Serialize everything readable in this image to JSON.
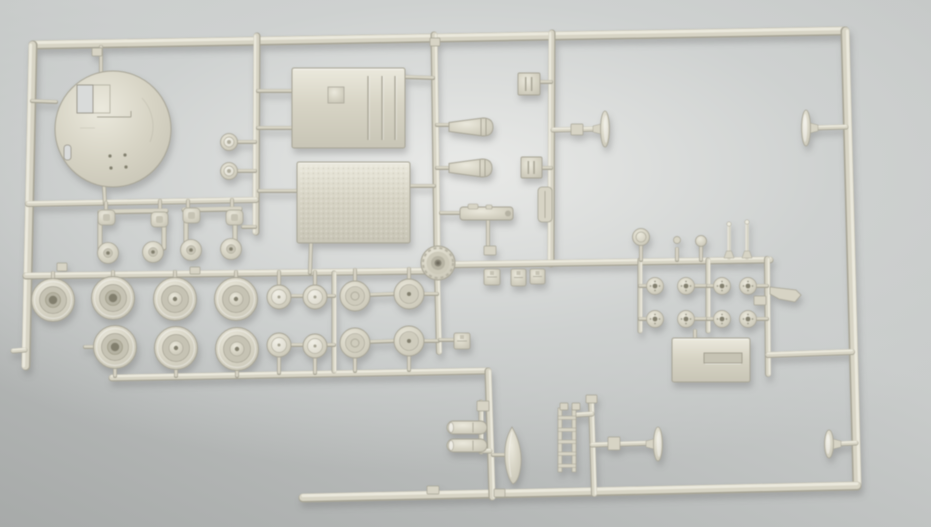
{
  "scene": {
    "description": "Photograph of a cream-colored injection-molded plastic model kit sprue (parts tree) with tank parts - wheels, hull panels, circular base plate, hatches and small fittings - lying on a gray surface",
    "palette": {
      "plastic_light": "#ebe9dd",
      "plastic_base": "#d7d4c5",
      "plastic_mid": "#c8c5b6",
      "plastic_dark": "#a7a495",
      "recess": "#c6c3b4",
      "recess_deep": "#b5b2a2",
      "hole_dark": "#827f6e",
      "bg_hole": "#d9dbda",
      "shadow": "#696c6b",
      "bg_light": "#e9eae8",
      "bg_mid": "#ced1d0",
      "bg_dark": "#a7aaa9"
    }
  },
  "sprue": {
    "frame_runners": [
      {
        "name": "runner-frame-top",
        "x1": 33,
        "y1": 45,
        "x2": 845,
        "y2": 31,
        "w": 9
      },
      {
        "name": "runner-frame-right",
        "x1": 845,
        "y1": 31,
        "x2": 857,
        "y2": 486,
        "w": 9
      },
      {
        "name": "runner-frame-bottom",
        "x1": 857,
        "y1": 486,
        "x2": 303,
        "y2": 498,
        "w": 9
      },
      {
        "name": "runner-frame-left",
        "x1": 33,
        "y1": 45,
        "x2": 26,
        "y2": 366,
        "w": 9
      }
    ],
    "inner_runners": [
      {
        "name": "runner-v1",
        "x1": 257,
        "y1": 36,
        "x2": 256,
        "y2": 232,
        "w": 7
      },
      {
        "name": "runner-v2",
        "x1": 434,
        "y1": 35,
        "x2": 437,
        "y2": 250,
        "w": 7
      },
      {
        "name": "runner-v3",
        "x1": 552,
        "y1": 33,
        "x2": 551,
        "y2": 264,
        "w": 7
      },
      {
        "name": "runner-frames-branch",
        "x1": 28,
        "y1": 204,
        "x2": 256,
        "y2": 200,
        "w": 6
      },
      {
        "name": "runner-wheels-top",
        "x1": 26,
        "y1": 276,
        "x2": 437,
        "y2": 271,
        "w": 7
      },
      {
        "name": "runner-wheel-column",
        "x1": 437,
        "y1": 271,
        "x2": 439,
        "y2": 352,
        "w": 6
      },
      {
        "name": "runner-wheels-bottom",
        "x1": 112,
        "y1": 378,
        "x2": 488,
        "y2": 371,
        "w": 7
      },
      {
        "name": "runner-center-lower",
        "x1": 488,
        "y1": 371,
        "x2": 492,
        "y2": 497,
        "w": 7
      },
      {
        "name": "runner-mid-horizontal",
        "x1": 437,
        "y1": 265,
        "x2": 770,
        "y2": 260,
        "w": 7
      },
      {
        "name": "runner-sub-right-1",
        "x1": 640,
        "y1": 260,
        "x2": 640,
        "y2": 331,
        "w": 5
      },
      {
        "name": "runner-sub-right-2",
        "x1": 708,
        "y1": 260,
        "x2": 708,
        "y2": 331,
        "w": 5
      },
      {
        "name": "runner-sub-right-3",
        "x1": 767,
        "y1": 259,
        "x2": 768,
        "y2": 374,
        "w": 6
      },
      {
        "name": "runner-right-link",
        "x1": 768,
        "y1": 355,
        "x2": 852,
        "y2": 352,
        "w": 6
      },
      {
        "name": "runner-lower-right",
        "x1": 591,
        "y1": 399,
        "x2": 594,
        "y2": 494,
        "w": 6
      },
      {
        "name": "runner-ladder-branch",
        "x1": 576,
        "y1": 415,
        "x2": 592,
        "y2": 414,
        "w": 5
      },
      {
        "name": "runner-idler-branch",
        "x1": 592,
        "y1": 445,
        "x2": 654,
        "y2": 443,
        "w": 5
      },
      {
        "name": "runner-mini-wheels",
        "x1": 334,
        "y1": 273,
        "x2": 334,
        "y2": 371,
        "w": 5
      },
      {
        "name": "runner-mini-cylinders",
        "x1": 481,
        "y1": 402,
        "x2": 481,
        "y2": 452,
        "w": 5
      },
      {
        "name": "runner-cyl-elbow",
        "x1": 481,
        "y1": 451,
        "x2": 490,
        "y2": 451,
        "w": 5
      },
      {
        "name": "runner-t1-branch",
        "x1": 553,
        "y1": 130,
        "x2": 601,
        "y2": 129,
        "w": 5
      },
      {
        "name": "stem-idler-right-top",
        "x1": 812,
        "y1": 128,
        "x2": 846,
        "y2": 127,
        "w": 5
      },
      {
        "name": "stem-idler-right-bottom",
        "x1": 836,
        "y1": 444,
        "x2": 856,
        "y2": 443,
        "w": 5
      },
      {
        "name": "stem-left-foot",
        "x1": 25,
        "y1": 350,
        "x2": 13,
        "y2": 351,
        "w": 5
      }
    ],
    "stems": [
      [
        101,
        47,
        101,
        73
      ],
      [
        32,
        101,
        56,
        102
      ],
      [
        104,
        186,
        105,
        204
      ],
      [
        258,
        91,
        293,
        91
      ],
      [
        258,
        128,
        293,
        128
      ],
      [
        404,
        77,
        433,
        78
      ],
      [
        259,
        191,
        298,
        191
      ],
      [
        410,
        186,
        434,
        186
      ],
      [
        311,
        243,
        310,
        273
      ],
      [
        238,
        142,
        255,
        142
      ],
      [
        238,
        171,
        255,
        171
      ],
      [
        106,
        203,
        106,
        212
      ],
      [
        160,
        201,
        160,
        212
      ],
      [
        188,
        201,
        188,
        210
      ],
      [
        232,
        200,
        232,
        209
      ],
      [
        243,
        227,
        255,
        227
      ],
      [
        53,
        273,
        53,
        282
      ],
      [
        113,
        272,
        113,
        281
      ],
      [
        175,
        272,
        175,
        281
      ],
      [
        236,
        272,
        236,
        281
      ],
      [
        279,
        272,
        279,
        286
      ],
      [
        315,
        272,
        315,
        286
      ],
      [
        355,
        270,
        355,
        282
      ],
      [
        409,
        269,
        409,
        280
      ],
      [
        115,
        368,
        115,
        376
      ],
      [
        176,
        369,
        176,
        376
      ],
      [
        237,
        370,
        237,
        376
      ],
      [
        279,
        356,
        279,
        373
      ],
      [
        315,
        357,
        315,
        373
      ],
      [
        355,
        357,
        355,
        371
      ],
      [
        409,
        355,
        409,
        370
      ],
      [
        85,
        347,
        94,
        347
      ],
      [
        368,
        295,
        395,
        294
      ],
      [
        368,
        342,
        395,
        341
      ],
      [
        292,
        296,
        304,
        296
      ],
      [
        292,
        345,
        304,
        345
      ],
      [
        326,
        296,
        334,
        296
      ],
      [
        326,
        345,
        334,
        345
      ],
      [
        424,
        294,
        437,
        294
      ],
      [
        424,
        341,
        438,
        341
      ],
      [
        440,
        340,
        454,
        340
      ],
      [
        640,
        286,
        648,
        286
      ],
      [
        694,
        286,
        708,
        286
      ],
      [
        708,
        286,
        714,
        286
      ],
      [
        755,
        286,
        767,
        286
      ],
      [
        640,
        319,
        648,
        319
      ],
      [
        694,
        319,
        708,
        319
      ],
      [
        708,
        319,
        714,
        319
      ],
      [
        755,
        319,
        767,
        319
      ],
      [
        437,
        125,
        450,
        125
      ],
      [
        437,
        168,
        450,
        168
      ],
      [
        540,
        82,
        551,
        82
      ],
      [
        542,
        168,
        551,
        168
      ],
      [
        441,
        213,
        462,
        213
      ],
      [
        488,
        221,
        488,
        252
      ],
      [
        695,
        331,
        695,
        339
      ],
      [
        493,
        455,
        507,
        455
      ],
      [
        641,
        245,
        641,
        260
      ],
      [
        677,
        249,
        677,
        260
      ],
      [
        701,
        246,
        701,
        260
      ]
    ],
    "gates": [
      [
        57,
        263,
        10,
        8
      ],
      [
        92,
        48,
        10,
        8
      ],
      [
        190,
        267,
        10,
        7
      ],
      [
        430,
        38,
        10,
        8
      ],
      [
        427,
        486,
        12,
        8
      ],
      [
        494,
        489,
        11,
        8
      ],
      [
        477,
        401,
        12,
        10
      ],
      [
        586,
        395,
        11,
        8
      ],
      [
        608,
        437,
        12,
        13
      ],
      [
        754,
        296,
        12,
        9
      ],
      [
        484,
        246,
        12,
        9
      ],
      [
        571,
        124,
        12,
        11
      ],
      [
        560,
        403,
        8,
        7
      ],
      [
        572,
        403,
        8,
        7
      ]
    ],
    "parts": [
      {
        "name": "circular-base-plate",
        "type": "disc",
        "cx": 113,
        "cy": 129,
        "r": 58
      },
      {
        "name": "hull-roof-panel",
        "type": "panel",
        "x": 292,
        "y": 68,
        "w": 113,
        "h": 80,
        "grooves": [
          368,
          382,
          395
        ],
        "emblem": [
          328,
          87,
          16,
          16
        ]
      },
      {
        "name": "textured-deck-panel",
        "type": "panel",
        "x": 297,
        "y": 162,
        "w": 113,
        "h": 81,
        "textured": true
      },
      {
        "name": "engine-access-plate",
        "type": "panel",
        "x": 672,
        "y": 338,
        "w": 78,
        "h": 44,
        "slot": [
          704,
          353,
          38,
          10
        ]
      },
      {
        "name": "road-wheel",
        "type": "wheelL",
        "cx": 53,
        "cy": 300,
        "hub": "open"
      },
      {
        "name": "road-wheel",
        "type": "wheelL",
        "cx": 113,
        "cy": 298,
        "hub": "open"
      },
      {
        "name": "road-wheel",
        "type": "wheelL",
        "cx": 175,
        "cy": 299,
        "hub": "cap"
      },
      {
        "name": "road-wheel",
        "type": "wheelL",
        "cx": 236,
        "cy": 299,
        "hub": "cap"
      },
      {
        "name": "road-wheel",
        "type": "wheelL",
        "cx": 115,
        "cy": 347,
        "hub": "open"
      },
      {
        "name": "road-wheel",
        "type": "wheelL",
        "cx": 176,
        "cy": 348,
        "hub": "cap"
      },
      {
        "name": "road-wheel",
        "type": "wheelL",
        "cx": 237,
        "cy": 349,
        "hub": "cap"
      },
      {
        "name": "return-roller",
        "type": "wheelS",
        "cx": 279,
        "cy": 297
      },
      {
        "name": "return-roller",
        "type": "wheelS",
        "cx": 315,
        "cy": 297
      },
      {
        "name": "return-roller",
        "type": "wheelS",
        "cx": 279,
        "cy": 345
      },
      {
        "name": "return-roller",
        "type": "wheelS",
        "cx": 315,
        "cy": 346
      },
      {
        "name": "road-wheel-small",
        "type": "wheelM",
        "cx": 355,
        "cy": 296,
        "style": "swirl"
      },
      {
        "name": "road-wheel-small",
        "type": "wheelM",
        "cx": 409,
        "cy": 294,
        "style": "dot"
      },
      {
        "name": "road-wheel-small",
        "type": "wheelM",
        "cx": 355,
        "cy": 343,
        "style": "swirl"
      },
      {
        "name": "road-wheel-small",
        "type": "wheelM",
        "cx": 409,
        "cy": 341,
        "style": "dot"
      },
      {
        "name": "drive-sprocket-hub",
        "type": "sprocket",
        "cx": 438,
        "cy": 263
      },
      {
        "name": "wheel-hub-cap",
        "type": "hub",
        "cx": 655,
        "cy": 286
      },
      {
        "name": "wheel-hub-cap",
        "type": "hub",
        "cx": 686,
        "cy": 286
      },
      {
        "name": "wheel-hub-cap",
        "type": "hub",
        "cx": 722,
        "cy": 286
      },
      {
        "name": "wheel-hub-cap",
        "type": "hub",
        "cx": 748,
        "cy": 286
      },
      {
        "name": "wheel-hub-cap",
        "type": "hub",
        "cx": 655,
        "cy": 319
      },
      {
        "name": "wheel-hub-cap",
        "type": "hub",
        "cx": 686,
        "cy": 319
      },
      {
        "name": "wheel-hub-cap",
        "type": "hub",
        "cx": 722,
        "cy": 319
      },
      {
        "name": "wheel-hub-cap",
        "type": "hub",
        "cx": 748,
        "cy": 319
      },
      {
        "name": "stowage-box",
        "type": "box",
        "x": 518,
        "y": 73,
        "w": 22,
        "h": 22
      },
      {
        "name": "stowage-box",
        "type": "box",
        "x": 521,
        "y": 157,
        "w": 21,
        "h": 21
      },
      {
        "name": "exhaust-muffler",
        "type": "cone",
        "x": 449,
        "cy": 127,
        "len": 42
      },
      {
        "name": "exhaust-muffler",
        "type": "cone",
        "x": 449,
        "cy": 168,
        "len": 41
      },
      {
        "name": "gun-mount-part",
        "type": "mg",
        "x": 460,
        "y": 207,
        "w": 53,
        "h": 13
      },
      {
        "name": "flat-bracket",
        "type": "slab",
        "x": 538,
        "y": 187,
        "w": 14,
        "h": 35
      },
      {
        "name": "idler-wheel-half",
        "type": "mushroom",
        "cx": 605,
        "cy": 129,
        "ry": 18,
        "dir": -1
      },
      {
        "name": "idler-wheel-half",
        "type": "mushroom",
        "cx": 806,
        "cy": 128,
        "ry": 18,
        "dir": 1
      },
      {
        "name": "idler-wheel-half",
        "type": "mushroom",
        "cx": 829,
        "cy": 444,
        "ry": 14,
        "dir": 1
      },
      {
        "name": "idler-wheel-half",
        "type": "mushroom",
        "cx": 658,
        "cy": 444,
        "ry": 17,
        "dir": -1
      },
      {
        "name": "hub-cap-pin",
        "type": "pinDisc",
        "cx": 641,
        "cy": 237
      },
      {
        "name": "small-pin",
        "type": "pinSmall",
        "cx": 677,
        "cy": 240
      },
      {
        "name": "ball-pin",
        "type": "pinBall",
        "cx": 701,
        "cy": 241
      },
      {
        "name": "antenna-pin",
        "type": "pinTall",
        "cx": 729,
        "y1": 222,
        "y2": 258
      },
      {
        "name": "antenna-pin",
        "type": "pinTall",
        "cx": 747,
        "y1": 220,
        "y2": 258
      },
      {
        "name": "small-clip",
        "type": "clip",
        "x": 484,
        "y": 269,
        "w": 16,
        "h": 16
      },
      {
        "name": "small-clip",
        "type": "clip",
        "x": 511,
        "y": 269,
        "w": 15,
        "h": 17
      },
      {
        "name": "small-clip",
        "type": "clip",
        "x": 530,
        "y": 269,
        "w": 15,
        "h": 15
      },
      {
        "name": "small-clip",
        "type": "clip",
        "x": 454,
        "y": 333,
        "w": 16,
        "h": 16
      },
      {
        "name": "tow-bracket",
        "type": "bracket",
        "d": "M770,287 L796,290 L801,295 L795,302 L779,299 L770,294 Z"
      },
      {
        "name": "shovel-blade",
        "type": "blade",
        "d": "M512,427 C518,437 522,451 521,464 C520,475 517,482 513,484 C510,482 506,472 505,460 C504,446 507,435 512,427 Z"
      },
      {
        "name": "ladder-part",
        "type": "ladder",
        "x": 558,
        "y": 408
      },
      {
        "name": "gun-barrel-half",
        "type": "cyl",
        "x": 447,
        "y": 421,
        "len": 40,
        "h": 13
      },
      {
        "name": "gun-barrel-half",
        "type": "cyl",
        "x": 447,
        "y": 439,
        "len": 40,
        "h": 13
      },
      {
        "name": "hatch-cap",
        "type": "knob",
        "cx": 229,
        "cy": 142
      },
      {
        "name": "hatch-cap",
        "type": "knob",
        "cx": 229,
        "cy": 171
      },
      {
        "name": "suspension-frame",
        "type": "frame",
        "bars": [
          [
            100,
            213,
            100,
            250
          ],
          [
            164,
            213,
            164,
            248
          ],
          [
            100,
            212,
            166,
            211
          ]
        ],
        "knobs": [
          [
            98,
            210
          ],
          [
            151,
            212
          ]
        ],
        "discs": [
          [
            108,
            253
          ],
          [
            153,
            252
          ]
        ]
      },
      {
        "name": "suspension-frame",
        "type": "frame",
        "bars": [
          [
            186,
            211,
            186,
            248
          ],
          [
            235,
            211,
            235,
            246
          ],
          [
            184,
            210,
            240,
            209
          ]
        ],
        "knobs": [
          [
            183,
            208
          ],
          [
            226,
            210
          ]
        ],
        "discs": [
          [
            191,
            250
          ],
          [
            231,
            249
          ]
        ]
      }
    ]
  }
}
